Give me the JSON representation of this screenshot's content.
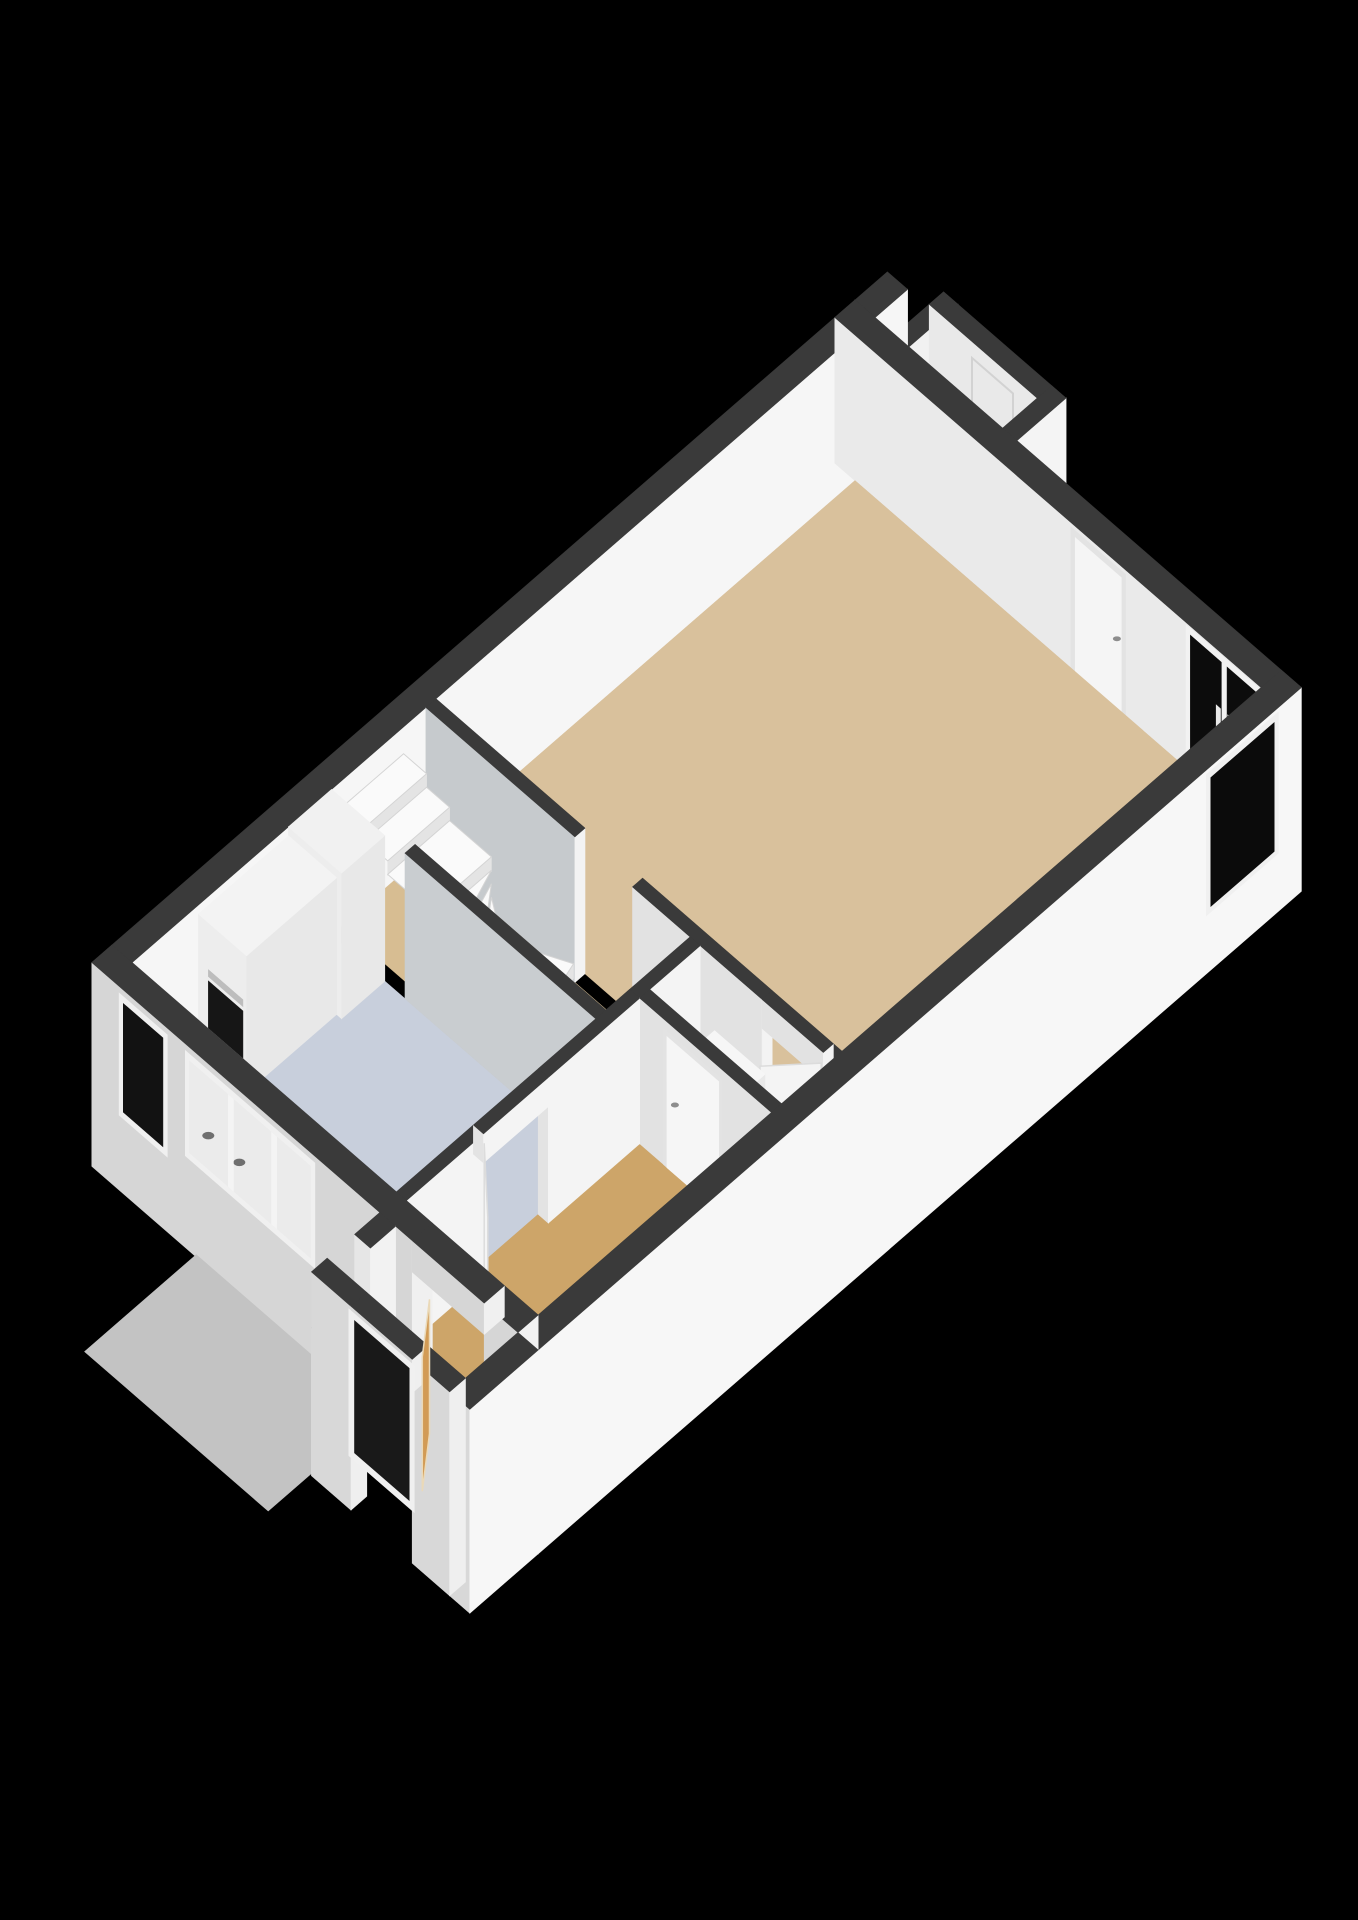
{
  "canvas": {
    "width": 1358,
    "height": 1920,
    "background": "#000000"
  },
  "view": {
    "type": "isometric-3d-floorplan",
    "projection": {
      "origin": [
        855,
        300
      ],
      "kx": 72,
      "ky": 62.5,
      "kz": 112,
      "zref": 1.3
    }
  },
  "palette": {
    "wall_top_band": "#3a3a3a",
    "wall_white": "#f6f6f6",
    "wall_light": "#f0f0f0",
    "wall_interior_gray": "#c6cacd",
    "facade_shadow": "#d6d6d6",
    "floor_living": "#d9c19c",
    "floor_hall": "#cda569",
    "floor_kitchen": "#c8cfdc",
    "floor_vestibule": "#d0a163",
    "doorstep_platform": "#c3c3c3",
    "glass_dark": "#0c0c0c",
    "oven_black": "#161616",
    "stair_tread": "#fafafa",
    "door_leaf_tan": "#d29b55"
  },
  "rooms": [
    {
      "name": "living-room",
      "floor": "#d9c19c"
    },
    {
      "name": "kitchen",
      "floor": "#c8cfdc"
    },
    {
      "name": "stair-hall",
      "floor": "#d7bd92"
    },
    {
      "name": "entrance-hall",
      "floor": "#cda569"
    },
    {
      "name": "toilet",
      "floor": "#cda569"
    },
    {
      "name": "vestibule",
      "floor": "#d0a163"
    },
    {
      "name": "storage-niche",
      "floor": "none"
    }
  ],
  "elements": [
    {
      "t": "box",
      "n": "storage-wall-nw",
      "x1": -0.68,
      "x2": 0,
      "y1": 0.55,
      "y2": 0.75,
      "z0": 0,
      "z1": 1.3,
      "top": "#3a3a3a",
      "fx": "#e8e8e8",
      "fy": "#f1f1f1"
    },
    {
      "t": "box",
      "n": "storage-wall-ne",
      "x1": -0.68,
      "x2": -0.48,
      "y1": 0.55,
      "y2": 2.25,
      "z0": 0,
      "z1": 1.3,
      "top": "#3a3a3a",
      "fx": "#e9e9e9",
      "fy": "#eeeeee"
    },
    {
      "t": "panelX",
      "n": "storage-door-outline",
      "x": -0.475,
      "y1": 1.15,
      "y2": 1.72,
      "z1": 0.02,
      "z2": 1.16,
      "fill": "none",
      "stroke": "#d2d2d2"
    },
    {
      "t": "box",
      "n": "storage-wall-se",
      "x1": -0.68,
      "x2": 0,
      "y1": 2.05,
      "y2": 2.25,
      "z0": 0,
      "z1": 1.3,
      "top": "#3a3a3a",
      "fx": "#e9e9e9",
      "fy": "#f4f4f4"
    },
    {
      "t": "box",
      "n": "wall-nw-stub",
      "x1": -0.45,
      "x2": 0,
      "y1": 0,
      "y2": 0.28,
      "z0": 0,
      "z1": 1.3,
      "top": "#3a3a3a",
      "fx": "#e9e9e9",
      "fy": "#f6f6f6"
    },
    {
      "t": "box",
      "n": "wall-nw",
      "x1": 0,
      "x2": 10.6,
      "y1": 0,
      "y2": 0.28,
      "z0": 0,
      "z1": 1.3,
      "top": "#3a3a3a",
      "fy": "#f6f6f6"
    },
    {
      "t": "box",
      "n": "wall-ne",
      "x1": 0,
      "x2": 0.28,
      "y1": 0,
      "y2": 6.2,
      "z0": 0,
      "z1": 1.3,
      "top": "#3a3a3a",
      "fx": "#eaeaea"
    },
    {
      "t": "panelX",
      "n": "livingroom-door-frame",
      "x": 0.281,
      "y1": 3.28,
      "y2": 4.04,
      "z1": 0,
      "z2": 1.26,
      "fill": "#e3e3e3"
    },
    {
      "t": "panelX",
      "n": "livingroom-door-leaf",
      "x": 0.282,
      "y1": 3.34,
      "y2": 3.98,
      "z1": 0,
      "z2": 1.2,
      "fill": "#f5f5f5"
    },
    {
      "t": "dot",
      "n": "livingroom-door-handle",
      "x": 0.282,
      "y": 3.92,
      "z": 0.62,
      "r": 4,
      "fill": "#8d8d8d"
    },
    {
      "t": "panelX",
      "n": "sliding-door-frame",
      "x": 0.281,
      "y1": 4.88,
      "y2": 5.92,
      "z1": -0.02,
      "z2": 1.28,
      "fill": "#f2f2f2"
    },
    {
      "t": "panelX",
      "n": "sliding-door-glass-left",
      "x": 0.282,
      "y1": 4.94,
      "y2": 5.37,
      "z1": 0.04,
      "z2": 1.22,
      "fill": "#0c0c0c"
    },
    {
      "t": "panelX",
      "n": "sliding-door-glass-right",
      "x": 0.282,
      "y1": 5.45,
      "y2": 5.88,
      "z1": 0.04,
      "z2": 1.22,
      "fill": "#0c0c0c"
    },
    {
      "t": "panelX",
      "n": "sliding-door-handle-left",
      "x": 0.283,
      "y1": 5.3,
      "y2": 5.36,
      "z1": 0.5,
      "z2": 0.8,
      "fill": "#e9e9e9"
    },
    {
      "t": "panelX",
      "n": "sliding-door-handle-right",
      "x": 0.283,
      "y1": 5.46,
      "y2": 5.52,
      "z1": 0.5,
      "z2": 0.8,
      "fill": "#e9e9e9"
    },
    {
      "t": "floor",
      "n": "living-room-floor",
      "pts": [
        [
          0.28,
          0.28
        ],
        [
          6.1,
          0.28
        ],
        [
          6.1,
          5.92
        ],
        [
          0.28,
          5.92
        ]
      ],
      "z": 0,
      "fill": "#d9c19c"
    },
    {
      "t": "floor",
      "n": "stair-hall-floor",
      "pts": [
        [
          6.24,
          0.28
        ],
        [
          7.41,
          0.28
        ],
        [
          7.41,
          3.95
        ],
        [
          6.24,
          3.95
        ]
      ],
      "z": 0,
      "fill": "#d7bd92"
    },
    {
      "t": "floor",
      "n": "kitchen-floor",
      "pts": [
        [
          7.55,
          0.28
        ],
        [
          10.32,
          0.28
        ],
        [
          10.32,
          3.95
        ],
        [
          7.55,
          3.95
        ]
      ],
      "z": 0,
      "fill": "#c8cfdc"
    },
    {
      "t": "floor",
      "n": "entrance-hall-floor",
      "pts": [
        [
          6.24,
          3.95
        ],
        [
          10.32,
          3.95
        ],
        [
          10.32,
          5.92
        ],
        [
          6.24,
          5.92
        ]
      ],
      "z": 0,
      "fill": "#cda569"
    },
    {
      "t": "floor",
      "n": "vestibule-threshold",
      "pts": [
        [
          10.32,
          4.45
        ],
        [
          10.62,
          4.45
        ],
        [
          10.62,
          5.45
        ],
        [
          10.32,
          5.45
        ]
      ],
      "z": 0,
      "fill": "#d0a163"
    },
    {
      "t": "box",
      "n": "wall-stairs-living",
      "x1": 6.1,
      "x2": 6.24,
      "y1": 0.28,
      "y2": 2.35,
      "z0": 0,
      "z1": 1.3,
      "top": "#3a3a3a",
      "fx": "#c6cacd",
      "fy": "#f3f3f3"
    },
    {
      "t": "tread",
      "n": "stair-tread-1",
      "pts": [
        [
          6.55,
          0.28
        ],
        [
          7.41,
          0.28
        ],
        [
          7.41,
          0.6
        ],
        [
          6.55,
          0.6
        ]
      ],
      "z": 1.06
    },
    {
      "t": "tread",
      "n": "stair-tread-2",
      "pts": [
        [
          6.55,
          0.6
        ],
        [
          7.41,
          0.6
        ],
        [
          7.41,
          0.92
        ],
        [
          6.55,
          0.92
        ]
      ],
      "z": 0.94
    },
    {
      "t": "tread",
      "n": "stair-tread-3",
      "pts": [
        [
          6.55,
          0.92
        ],
        [
          7.41,
          0.92
        ],
        [
          7.41,
          1.5
        ],
        [
          6.55,
          1.5
        ]
      ],
      "z": 0.82
    },
    {
      "t": "tread",
      "n": "stair-winder-1",
      "pts": [
        [
          6.55,
          1.5
        ],
        [
          7.41,
          1.5
        ],
        [
          7.36,
          1.79
        ]
      ],
      "z": 0.7
    },
    {
      "t": "tread",
      "n": "stair-winder-2",
      "pts": [
        [
          6.55,
          1.5
        ],
        [
          7.36,
          1.79
        ],
        [
          7.23,
          2.03
        ]
      ],
      "z": 0.58
    },
    {
      "t": "tread",
      "n": "stair-winder-3",
      "pts": [
        [
          6.55,
          1.5
        ],
        [
          7.23,
          2.03
        ],
        [
          7.02,
          2.22
        ]
      ],
      "z": 0.46
    },
    {
      "t": "tread",
      "n": "stair-winder-4",
      "pts": [
        [
          6.55,
          1.5
        ],
        [
          7.02,
          2.22
        ],
        [
          6.76,
          2.33
        ]
      ],
      "z": 0.34
    },
    {
      "t": "tread",
      "n": "stair-winder-5",
      "pts": [
        [
          6.55,
          1.5
        ],
        [
          6.76,
          2.33
        ],
        [
          6.47,
          2.36
        ]
      ],
      "z": 0.22
    },
    {
      "t": "tread",
      "n": "stair-winder-6",
      "pts": [
        [
          6.55,
          1.5
        ],
        [
          6.47,
          2.36
        ],
        [
          6.19,
          2.28
        ]
      ],
      "z": 0.1
    },
    {
      "t": "box",
      "n": "wall-stairs-kitchen",
      "x1": 7.41,
      "x2": 7.55,
      "y1": 1.3,
      "y2": 3.95,
      "z0": 0,
      "z1": 1.3,
      "top": "#3a3a3a",
      "fx": "#c9cdd0",
      "fy": "#f3f3f3"
    },
    {
      "t": "box",
      "n": "kitchen-tall-cabinet",
      "x1": 7.55,
      "x2": 8.15,
      "y1": 0.28,
      "y2": 1.02,
      "z0": 0,
      "z1": 1.3,
      "top": "#f1f1f1",
      "fx": "#ededed",
      "fy": "#e8e8e8"
    },
    {
      "t": "box",
      "n": "kitchen-cabinet-run",
      "x1": 8.15,
      "x2": 9.4,
      "y1": 0.28,
      "y2": 0.95,
      "z0": 0,
      "z1": 1.22,
      "top": "#f3f3f3",
      "fx": "#ededed",
      "fy": "#e8e8e8"
    },
    {
      "t": "panelX",
      "n": "built-in-oven",
      "x": 9.401,
      "y1": 0.42,
      "y2": 0.9,
      "z1": 0.1,
      "z2": 0.7,
      "fill": "#161616"
    },
    {
      "t": "panelX",
      "n": "oven-handle",
      "x": 9.401,
      "y1": 0.42,
      "y2": 0.9,
      "z1": 0.74,
      "z2": 0.8,
      "fill": "#bdbdbd"
    },
    {
      "t": "box",
      "n": "kitchen-counter",
      "x1": 9.98,
      "x2": 10.32,
      "y1": 0.55,
      "y2": 2.85,
      "z0": 0,
      "z1": 0.92,
      "top": "#f4f4f4",
      "fx": "#e8e8e8",
      "fy": "#ececec"
    },
    {
      "t": "dot",
      "n": "hob-burner-1",
      "x": 10.16,
      "y": 1.38,
      "z": 0.92,
      "r": 7,
      "fill": "#5f5f5f"
    },
    {
      "t": "dot",
      "n": "hob-burner-2",
      "x": 10.16,
      "y": 1.78,
      "z": 0.92,
      "r": 7,
      "fill": "#5f5f5f"
    },
    {
      "t": "dot",
      "n": "hob-knob",
      "x": 10.16,
      "y": 1.58,
      "z": 0.92,
      "r": 3,
      "fill": "#a8a8a8"
    },
    {
      "t": "box",
      "n": "wall-hall-living",
      "x1": 6.1,
      "x2": 6.24,
      "y1": 3.15,
      "y2": 4.95,
      "z0": 0,
      "z1": 1.3,
      "top": "#3a3a3a",
      "fx": "#e2e2e2",
      "fy": "#f3f3f3"
    },
    {
      "t": "box",
      "n": "wall-hall-living-end",
      "x1": 6.1,
      "x2": 6.24,
      "y1": 5.8,
      "y2": 5.92,
      "z0": 0,
      "z1": 1.3,
      "top": "#3a3a3a",
      "fx": "#e2e2e2",
      "fy": "#f3f3f3"
    },
    {
      "t": "box",
      "n": "hall-door-header",
      "x1": 6.1,
      "x2": 6.24,
      "y1": 4.95,
      "y2": 5.8,
      "z0": 1.04,
      "z1": 1.3,
      "top": "#3a3a3a",
      "fx": "#e2e2e2",
      "fy": "#f3f3f3"
    },
    {
      "t": "quadv",
      "n": "hall-door-leaf-open",
      "a": [
        6.25,
        5.78
      ],
      "b": [
        6.7,
        5.38
      ],
      "z1": 0,
      "z2": 1.2,
      "fill": "#f4f4f4",
      "stroke": "#dcdcdc"
    },
    {
      "t": "box",
      "n": "toilet-wall-nw",
      "x1": 6.24,
      "x2": 7.08,
      "y1": 3.95,
      "y2": 4.09,
      "z0": 0,
      "z1": 1.3,
      "top": "#3a3a3a",
      "fx": "#e3e3e3",
      "fy": "#f4f4f4"
    },
    {
      "t": "box",
      "n": "toilet-cistern",
      "x1": 6.3,
      "x2": 6.52,
      "y1": 4.35,
      "y2": 5.05,
      "z0": 0,
      "z1": 0.72,
      "top": "#f6f6f6",
      "fx": "#eeeeee",
      "fy": "#e9e9e9"
    },
    {
      "t": "dot",
      "n": "toilet-bowl",
      "x": 6.72,
      "y": 4.7,
      "z": 0.42,
      "r": 14,
      "fill": "#f4f4f4"
    },
    {
      "t": "box",
      "n": "toilet-wall-sw",
      "x1": 6.94,
      "x2": 7.08,
      "y1": 4.09,
      "y2": 5.92,
      "z0": 0,
      "z1": 1.3,
      "top": "#3a3a3a",
      "fx": "#e2e2e2",
      "fy": "#f3f3f3"
    },
    {
      "t": "panelX",
      "n": "toilet-door-frame",
      "x": 7.081,
      "y1": 4.42,
      "y2": 5.24,
      "z1": 0,
      "z2": 1.22,
      "fill": "#e3e3e3"
    },
    {
      "t": "panelX",
      "n": "toilet-door-leaf",
      "x": 7.082,
      "y1": 4.47,
      "y2": 5.19,
      "z1": 0,
      "z2": 1.17,
      "fill": "#f6f6f6"
    },
    {
      "t": "dot",
      "n": "toilet-door-handle",
      "x": 7.082,
      "y": 4.58,
      "z": 0.62,
      "r": 4,
      "fill": "#8d8d8d"
    },
    {
      "t": "box",
      "n": "wall-kitchen-hall-a",
      "x1": 7.08,
      "x2": 8.35,
      "y1": 3.95,
      "y2": 4.09,
      "z0": 0,
      "z1": 1.3,
      "top": "#3a3a3a",
      "fx": "#e3e3e3",
      "fy": "#f4f4f4"
    },
    {
      "t": "box",
      "n": "wall-kitchen-hall-b",
      "x1": 9.25,
      "x2": 10.32,
      "y1": 3.95,
      "y2": 4.09,
      "z0": 0,
      "z1": 1.3,
      "top": "#3a3a3a",
      "fx": "#e3e3e3",
      "fy": "#f4f4f4"
    },
    {
      "t": "box",
      "n": "kitchen-hall-door-header",
      "x1": 8.35,
      "x2": 9.25,
      "y1": 3.95,
      "y2": 4.09,
      "z0": 1.04,
      "z1": 1.3,
      "top": "#3a3a3a",
      "fx": "#e3e3e3",
      "fy": "#f4f4f4"
    },
    {
      "t": "quadv",
      "n": "kitchen-hall-door-leaf",
      "a": [
        9.25,
        4.1
      ],
      "b": [
        9.82,
        4.72
      ],
      "z1": 0,
      "z2": 1.22,
      "fill": "#f4f4f4",
      "stroke": "#dcdcdc"
    },
    {
      "t": "box",
      "n": "wall-se",
      "x1": 0,
      "x2": 10.6,
      "y1": 5.92,
      "y2": 6.2,
      "z0": -0.52,
      "z1": 1.3,
      "top": "#3a3a3a",
      "fx": "#d6d6d6",
      "fy": "#f7f7f7"
    },
    {
      "t": "panelY",
      "n": "se-corner-window-frame",
      "y": 6.201,
      "x1": 0.32,
      "x2": 1.32,
      "z1": 0,
      "z2": 1.26,
      "fill": "#f0f0f0"
    },
    {
      "t": "panelY",
      "n": "se-corner-window-glass",
      "y": 6.202,
      "x1": 0.38,
      "x2": 1.26,
      "z1": 0.05,
      "z2": 1.2,
      "fill": "#0b0b0b"
    },
    {
      "t": "box",
      "n": "wall-sw-a",
      "x1": 10.32,
      "x2": 10.6,
      "y1": 0,
      "y2": 4.45,
      "z0": -0.52,
      "z1": 1.3,
      "top": "#3a3a3a",
      "fx": "#d6d6d6",
      "fy": "#f0f0f0"
    },
    {
      "t": "box",
      "n": "wall-sw-b",
      "x1": 10.32,
      "x2": 10.6,
      "y1": 5.45,
      "y2": 5.92,
      "z0": -0.52,
      "z1": 1.3,
      "top": "#3a3a3a",
      "fx": "#d6d6d6",
      "fy": "#f2f2f2"
    },
    {
      "t": "box",
      "n": "vestibule-doorway-header",
      "x1": 10.32,
      "x2": 10.6,
      "y1": 4.45,
      "y2": 5.45,
      "z0": 1.02,
      "z1": 1.3,
      "top": "#3a3a3a",
      "fx": "#d6d6d6",
      "fy": "#f0f0f0"
    },
    {
      "t": "panelX",
      "n": "facade-narrow-window-frame",
      "x": 10.601,
      "y1": 0.38,
      "y2": 1.05,
      "z1": 0.15,
      "z2": 1.24,
      "fill": "#f0f0f0"
    },
    {
      "t": "panelX",
      "n": "facade-narrow-window-glass",
      "x": 10.602,
      "y1": 0.44,
      "y2": 0.99,
      "z1": 0.21,
      "z2": 1.18,
      "fill": "#121212"
    },
    {
      "t": "panelX",
      "n": "kitchen-window-frame",
      "x": 10.601,
      "y1": 1.3,
      "y2": 3.1,
      "z1": 0.3,
      "z2": 1.24,
      "fill": "#f0f0f0"
    },
    {
      "t": "panelX",
      "n": "kitchen-window-opening",
      "x": 10.602,
      "y1": 1.36,
      "y2": 3.04,
      "z1": 0.36,
      "z2": 1.18,
      "fill": "#ebebeb"
    },
    {
      "t": "dot",
      "n": "faucet-through-window-1",
      "x": 10.602,
      "y": 1.62,
      "z": 0.66,
      "r": 6,
      "fill": "#6f6f6f"
    },
    {
      "t": "dot",
      "n": "faucet-through-window-2",
      "x": 10.602,
      "y": 2.05,
      "z": 0.66,
      "r": 6,
      "fill": "#6f6f6f"
    },
    {
      "t": "panelX",
      "n": "kitchen-window-mullion-1",
      "x": 10.603,
      "y1": 1.9,
      "y2": 1.97,
      "z1": 0.36,
      "z2": 1.18,
      "fill": "#f4f4f4"
    },
    {
      "t": "panelX",
      "n": "kitchen-window-mullion-2",
      "x": 10.603,
      "y1": 2.5,
      "y2": 2.57,
      "z1": 0.36,
      "z2": 1.18,
      "fill": "#f4f4f4"
    },
    {
      "t": "floor",
      "n": "doorstep-platform",
      "pts": [
        [
          10.6,
          1.45
        ],
        [
          12.15,
          1.45
        ],
        [
          12.15,
          4.0
        ],
        [
          10.6,
          4.0
        ]
      ],
      "z": -0.5,
      "fill": "#c3c3c3"
    },
    {
      "t": "floor",
      "n": "vestibule-floor",
      "pts": [
        [
          10.6,
          4.22
        ],
        [
          11.35,
          4.22
        ],
        [
          11.35,
          5.92
        ],
        [
          10.6,
          5.92
        ]
      ],
      "z": 0,
      "fill": "#d0a163"
    },
    {
      "t": "box",
      "n": "vestibule-wall-nw",
      "x1": 10.6,
      "x2": 10.95,
      "y1": 4.0,
      "y2": 4.22,
      "z0": -0.5,
      "z1": 1.3,
      "top": "#3a3a3a",
      "fx": "#e6e6e6",
      "fy": "#f2f2f2"
    },
    {
      "t": "box",
      "n": "vestibule-radiator",
      "x1": 10.98,
      "x2": 11.28,
      "y1": 4.24,
      "y2": 4.44,
      "z0": 0,
      "z1": 0.55,
      "top": "#f7f7f7",
      "fx": "#ebebeb",
      "fy": "#f0f0f0"
    },
    {
      "t": "box",
      "n": "vestibule-niche-halfwall",
      "x1": 10.95,
      "x2": 11.55,
      "y1": 4.0,
      "y2": 4.22,
      "z0": -0.5,
      "z1": 0.8,
      "top": "#3a3a3a",
      "fx": "#e6e6e6",
      "fy": "#f2f2f2"
    },
    {
      "t": "box",
      "n": "vestibule-wall-se",
      "x1": 10.6,
      "x2": 11.55,
      "y1": 5.92,
      "y2": 6.2,
      "z0": -0.52,
      "z1": 1.3,
      "top": "#3a3a3a",
      "fx": "#d8d8d8",
      "fy": "#f7f7f7"
    },
    {
      "t": "box",
      "n": "vestibule-wall-sw-a",
      "x1": 11.33,
      "x2": 11.55,
      "y1": 4.0,
      "y2": 4.55,
      "z0": -0.52,
      "z1": 1.3,
      "top": "#3a3a3a",
      "fx": "#d8d8d8",
      "fy": "#efefef"
    },
    {
      "t": "box",
      "n": "vestibule-wall-sw-b",
      "x1": 11.33,
      "x2": 11.55,
      "y1": 5.4,
      "y2": 5.92,
      "z0": -0.52,
      "z1": 1.3,
      "top": "#3a3a3a",
      "fx": "#d8d8d8",
      "fy": "#efefef"
    },
    {
      "t": "box",
      "n": "front-door-header",
      "x1": 11.33,
      "x2": 11.55,
      "y1": 4.55,
      "y2": 5.4,
      "z0": 1.0,
      "z1": 1.3,
      "top": "#3a3a3a",
      "fx": "#d8d8d8",
      "fy": "#efefef"
    },
    {
      "t": "panelX",
      "n": "front-door-frame",
      "x": 11.551,
      "y1": 4.52,
      "y2": 5.43,
      "z1": -0.05,
      "z2": 1.26,
      "fill": "#f0f0f0"
    },
    {
      "t": "panelX",
      "n": "front-door-opening",
      "x": 11.552,
      "y1": 4.6,
      "y2": 5.36,
      "z1": 0.02,
      "z2": 1.2,
      "fill": "#191919"
    },
    {
      "t": "quadv",
      "n": "front-door-leaf-ajar",
      "a": [
        11.37,
        5.36
      ],
      "b": [
        10.86,
        4.95
      ],
      "z1": 0,
      "z2": 1.2,
      "fill": "#d29b55",
      "stroke": "#ead9b8"
    }
  ]
}
